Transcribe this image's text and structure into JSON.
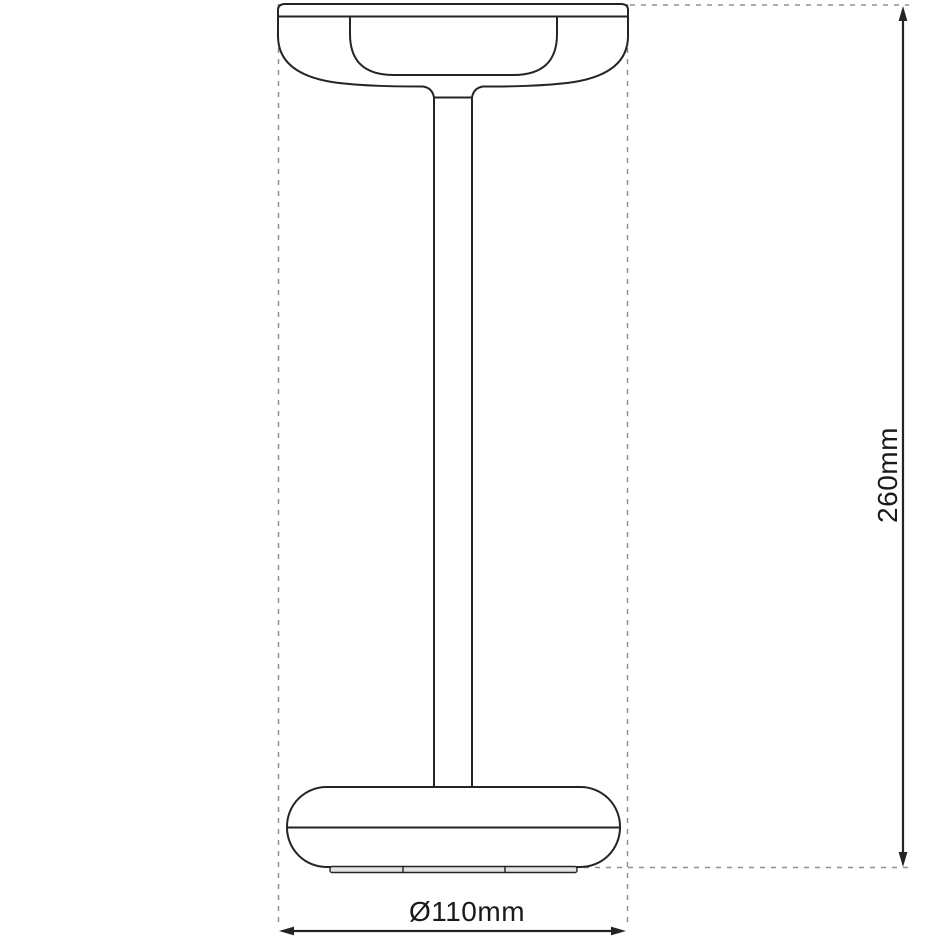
{
  "figure": {
    "height_label": "260mm",
    "diameter_label": "Ø110mm",
    "colors": {
      "outline": "#242424",
      "extension": "#8f8f8f",
      "text": "#1a1a1a",
      "background": "#ffffff",
      "foot_fill": "#e3e3e3"
    }
  }
}
